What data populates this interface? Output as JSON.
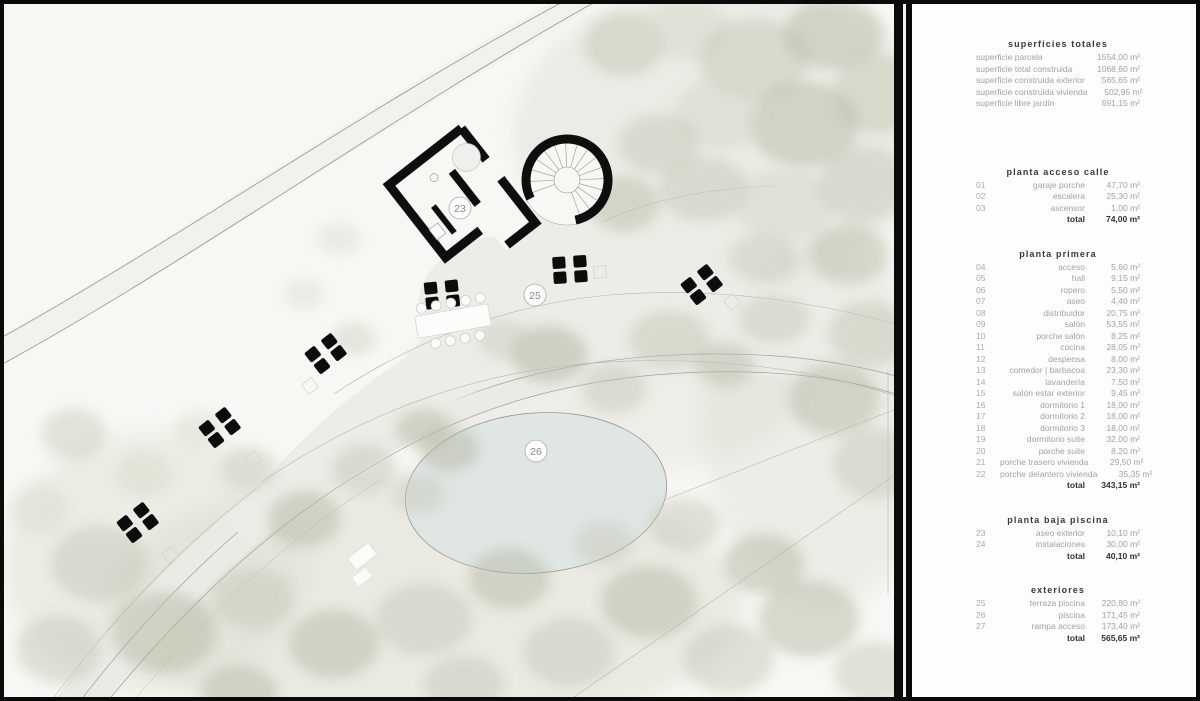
{
  "plan": {
    "markers": [
      {
        "label": "23"
      },
      {
        "label": "25"
      },
      {
        "label": "26"
      }
    ]
  },
  "panel": {
    "sections": [
      {
        "title": "superficies totales",
        "rows": [
          {
            "label": "superficie parcela",
            "value": "1554,00 m²"
          },
          {
            "label": "superficie total construida",
            "value": "1068,60 m²"
          },
          {
            "label": "superficie construida exterior",
            "value": "565,65 m²"
          },
          {
            "label": "superficie construida vivienda",
            "value": "502,95 m²"
          },
          {
            "label": "superficie libre jardín",
            "value": "691,15 m²"
          }
        ]
      },
      {
        "title": "planta acceso calle",
        "rows": [
          {
            "num": "01",
            "label": "garaje porche",
            "value": "47,70 m²"
          },
          {
            "num": "02",
            "label": "escalera",
            "value": "25,30 m²"
          },
          {
            "num": "03",
            "label": "ascensor",
            "value": "1,00 m²"
          }
        ],
        "total": {
          "label": "total",
          "value": "74,00 m²"
        }
      },
      {
        "title": "planta primera",
        "rows": [
          {
            "num": "04",
            "label": "acceso",
            "value": "5,60 m²"
          },
          {
            "num": "05",
            "label": "hall",
            "value": "9,15 m²"
          },
          {
            "num": "06",
            "label": "ropero",
            "value": "5,50 m²"
          },
          {
            "num": "07",
            "label": "aseo",
            "value": "4,40 m²"
          },
          {
            "num": "08",
            "label": "distribuidor",
            "value": "20,75 m²"
          },
          {
            "num": "09",
            "label": "salón",
            "value": "53,55 m²"
          },
          {
            "num": "10",
            "label": "porche salón",
            "value": "8,25 m²"
          },
          {
            "num": "11",
            "label": "cocina",
            "value": "28,05 m²"
          },
          {
            "num": "12",
            "label": "despensa",
            "value": "8,00 m²"
          },
          {
            "num": "13",
            "label": "comedor | barbacoa",
            "value": "23,30 m²"
          },
          {
            "num": "14",
            "label": "lavandería",
            "value": "7,50 m²"
          },
          {
            "num": "15",
            "label": "salón estar exterior",
            "value": "9,45 m²"
          },
          {
            "num": "16",
            "label": "dormitorio 1",
            "value": "18,00 m²"
          },
          {
            "num": "17",
            "label": "dormitorio 2",
            "value": "18,00 m²"
          },
          {
            "num": "18",
            "label": "dormitorio 3",
            "value": "18,00 m²"
          },
          {
            "num": "19",
            "label": "dormitorio suite",
            "value": "32,00 m²"
          },
          {
            "num": "20",
            "label": "porche suite",
            "value": "8,20 m²"
          },
          {
            "num": "21",
            "label": "porche trasero vivienda",
            "value": "29,50 m²"
          },
          {
            "num": "22",
            "label": "porche delantero vivienda",
            "value": "35,35 m²"
          }
        ],
        "total": {
          "label": "total",
          "value": "343,15 m²"
        }
      },
      {
        "title": "planta baja piscina",
        "rows": [
          {
            "num": "23",
            "label": "aseo exterior",
            "value": "10,10 m²"
          },
          {
            "num": "24",
            "label": "instalaciones",
            "value": "30,00 m²"
          }
        ],
        "total": {
          "label": "total",
          "value": "40,10 m²"
        }
      },
      {
        "title": "exteriores",
        "rows": [
          {
            "num": "25",
            "label": "terraza piscina",
            "value": "220,80 m²"
          },
          {
            "num": "26",
            "label": "piscina",
            "value": "171,45 m²"
          },
          {
            "num": "27",
            "label": "rampa acceso",
            "value": "173,40 m²"
          }
        ],
        "total": {
          "label": "total",
          "value": "565,65 m²"
        }
      }
    ]
  },
  "colors": {
    "wall": "#0e0e0e",
    "pool": "#dfe6e4",
    "terrace": "#edece7",
    "foliage": "#c3c4b4",
    "background": "#f8f7f4"
  }
}
